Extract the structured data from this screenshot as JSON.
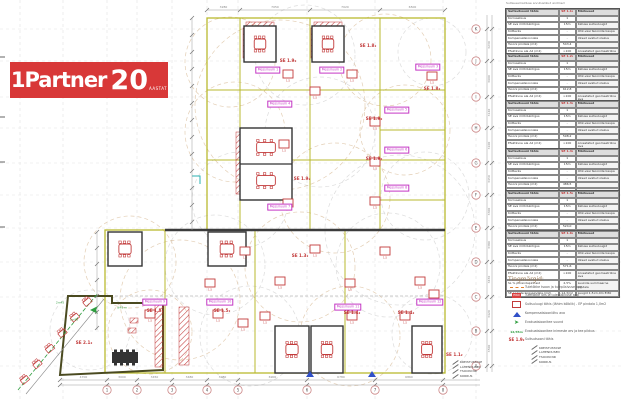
{
  "logo": {
    "name": "1Partner",
    "number": "20",
    "suffix": "AASTAT"
  },
  "tables_caption": "Suitsueemalduse arvutuslikud andmed",
  "tables": {
    "header_col1": "Suitsutsooni tähis",
    "header_col3": "Märkused",
    "row_labels": [
      "Korruselisus",
      "SE ava mõõdukõrgus",
      "Kütteviis",
      "Kompensatsiooniala",
      "Tsooni pindala (m2)",
      "Efektiivne ala A2 (m2)",
      "SL % põrandapinnast",
      "SE luukide kogupindala (m2)"
    ],
    "notes": [
      "",
      "Katuse suitsuluugid",
      "Õhk-vesi tsoonide kaupa",
      "Uksed avatud olekus",
      "",
      "Arvestatud geomeetriline ava",
      "Luukide summaarne pindala",
      "Luugid 1,5×1,0m EI30"
    ],
    "items": [
      {
        "zone": "SE 1.1₂",
        "values": [
          "1",
          "15m",
          "-",
          "-",
          "543,4",
          ">100",
          "2,5%",
          "13,6m2"
        ]
      },
      {
        "zone": "SE 1.2₂",
        "values": [
          "1",
          "15m",
          "-",
          "-",
          "612,8",
          ">100",
          "2,5%",
          "15,3m2"
        ]
      },
      {
        "zone": "SE 1.3₂",
        "values": [
          "1",
          "15m",
          "-",
          "-",
          "598,2",
          ">100",
          "2,5%",
          "15,0m2"
        ]
      },
      {
        "zone": "SE 1.4₂",
        "values": [
          "1",
          "15m",
          "-",
          "-",
          "486,5",
          ">100",
          "2,5%",
          "12,2m2"
        ]
      },
      {
        "zone": "SE 1.5₂",
        "values": [
          "1",
          "15m",
          "-",
          "-",
          "524,0",
          ">100",
          "2,5%",
          "13,1m2"
        ]
      },
      {
        "zone": "SE 1.6₂",
        "values": [
          "1",
          "15m",
          "-",
          "-",
          "571,6",
          ">100",
          "2,5%",
          "14,3m2"
        ]
      }
    ]
  },
  "legend": {
    "title": "Tingmärgid:",
    "items": [
      {
        "icon": "fire-zone-line-icon",
        "label": "Tuletõkke tsoon ja tulepüsivuse aeg"
      },
      {
        "icon": "fire-door-icon",
        "label": "Tuletõkke uks ja tulepüsivuse aeg"
      },
      {
        "icon": "smoke-hatch-icon",
        "label": "Suitsuluugi tähis (lähim kõlblik) - EP pindala 1,0m2"
      },
      {
        "icon": "compensation-air-icon",
        "label": "Kompensatsiooniõhu ava"
      },
      {
        "icon": "evacuation-direction-icon",
        "label": "Evakuatsioonitee suund"
      },
      {
        "icon": "evacuation-count-icon",
        "label": "Evakuatsioonitee inimeste arv ja tee pikkus"
      },
      {
        "icon": "smoke-zone-icon",
        "label": "Suitsutsooni tähis"
      }
    ],
    "smoke_zone_symbol": "SE 1.9₂",
    "evac_count_symbol": "12/45m",
    "fire_door_symbol": "EI60"
  },
  "callout": {
    "lines": [
      "KREISTUSTASE",
      "LAHENDUSED",
      "TSOONI NR",
      "KORRUS"
    ]
  },
  "plan": {
    "messiruum": [
      {
        "x": 268,
        "y": 70,
        "text": "Messiruum 1"
      },
      {
        "x": 332,
        "y": 70,
        "text": "Messiruum 2"
      },
      {
        "x": 428,
        "y": 67,
        "text": "Messiruum 3"
      },
      {
        "x": 280,
        "y": 104,
        "text": "Messiruum 4"
      },
      {
        "x": 397,
        "y": 110,
        "text": "Messiruum 5"
      },
      {
        "x": 397,
        "y": 150,
        "text": "Messiruum 6"
      },
      {
        "x": 280,
        "y": 207,
        "text": "Messiruum 7"
      },
      {
        "x": 397,
        "y": 188,
        "text": "Messiruum 8"
      },
      {
        "x": 155,
        "y": 302,
        "text": "Messiruum 9"
      },
      {
        "x": 220,
        "y": 302,
        "text": "Messiruum 10"
      },
      {
        "x": 348,
        "y": 307,
        "text": "Messiruum 11"
      },
      {
        "x": 430,
        "y": 302,
        "text": "Messiruum 12"
      }
    ],
    "se_labels": [
      {
        "x": 288,
        "y": 61,
        "text": "SE 1.9₂"
      },
      {
        "x": 368,
        "y": 46,
        "text": "SE 1.8₂"
      },
      {
        "x": 432,
        "y": 89,
        "text": "SE 1.8₂"
      },
      {
        "x": 374,
        "y": 119,
        "text": "SE 1.9₂"
      },
      {
        "x": 374,
        "y": 159,
        "text": "SE 1.9₂"
      },
      {
        "x": 302,
        "y": 179,
        "text": "SE 1.9₂"
      },
      {
        "x": 300,
        "y": 256,
        "text": "SE 1.3₂"
      },
      {
        "x": 155,
        "y": 311,
        "text": "SE 1.5₂"
      },
      {
        "x": 222,
        "y": 311,
        "text": "SE 1.5₂"
      },
      {
        "x": 352,
        "y": 313,
        "text": "SE 1.4₂"
      },
      {
        "x": 406,
        "y": 313,
        "text": "SE 1.4₂"
      },
      {
        "x": 84,
        "y": 343,
        "text": "SE 2.1₂"
      }
    ],
    "se_corner": {
      "text": "SE 1.1₂"
    },
    "hatch_caption": "1,5",
    "green_notes": [
      {
        "x": 60,
        "y": 303,
        "text": "2×45"
      },
      {
        "x": 74,
        "y": 320,
        "text": "1×90"
      },
      {
        "x": 122,
        "y": 308,
        "text": "≤45 m"
      }
    ],
    "grid_numbers": [
      "1",
      "2",
      "3",
      "4",
      "5",
      "6",
      "7",
      "8"
    ],
    "grid_letters": [
      "K",
      "J",
      "I",
      "H",
      "G",
      "F",
      "E",
      "D",
      "C",
      "B",
      "A"
    ],
    "dim_top": [
      "3280",
      "7050",
      "7020",
      "6500"
    ],
    "dim_bottom": [
      "4700",
      "3000",
      "3450",
      "3480",
      "3080",
      "6900",
      "6780",
      "6860"
    ],
    "dim_right": [
      "3230",
      "3600",
      "3140",
      "3100",
      "3450",
      "3300",
      "3380",
      "3450",
      "3420",
      "3500"
    ]
  },
  "colors": {
    "logo_red": "#d83838",
    "plan_red": "#c23b3b",
    "magenta": "#c437c4",
    "olive": "#b9b92f",
    "wall": "#3c3c3c",
    "arc_tan": "#d4b48c",
    "green": "#2f9e3f",
    "blue": "#3050c8"
  }
}
